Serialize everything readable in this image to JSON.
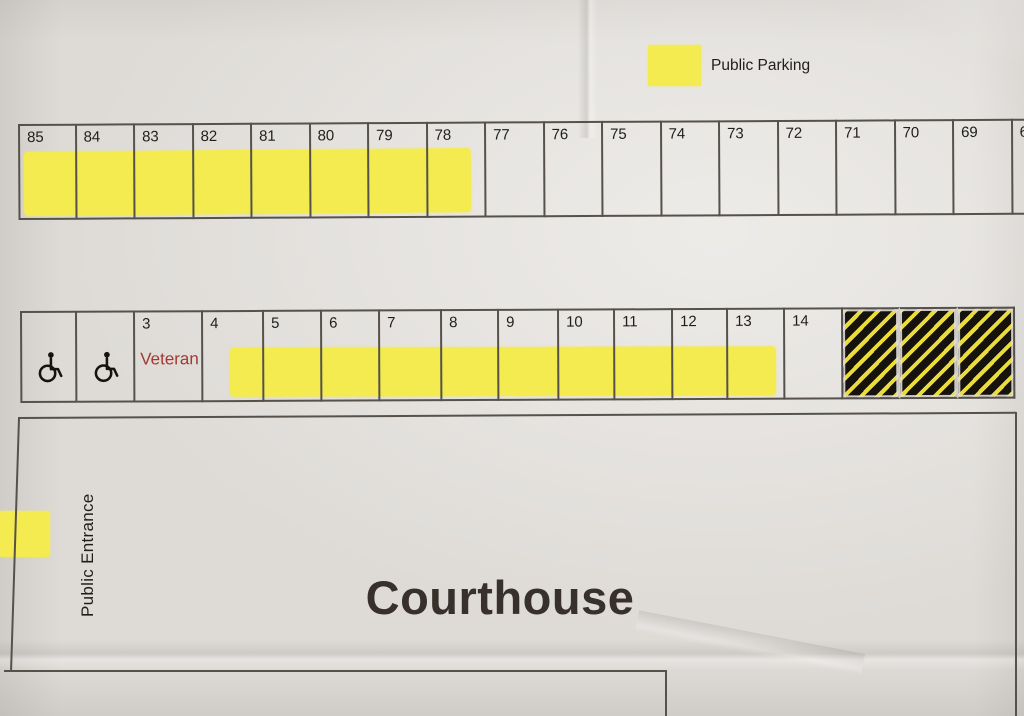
{
  "legend": {
    "label": "Public Parking",
    "swatch": "yellow-highlight-square"
  },
  "top_row": {
    "spaces": [
      "85",
      "84",
      "83",
      "82",
      "81",
      "80",
      "79",
      "78",
      "77",
      "76",
      "75",
      "74",
      "73",
      "72",
      "71",
      "70",
      "69",
      "68"
    ],
    "highlighted_spaces": [
      "85",
      "84",
      "83",
      "82",
      "81",
      "80",
      "79",
      "78"
    ]
  },
  "middle_row": {
    "cells": [
      {
        "type": "handicap",
        "icon": "wheelchair-icon"
      },
      {
        "type": "handicap",
        "icon": "wheelchair-icon"
      },
      {
        "type": "veteran",
        "number": "3",
        "label": "Veteran"
      },
      {
        "type": "space",
        "number": "4"
      },
      {
        "type": "space",
        "number": "5"
      },
      {
        "type": "space",
        "number": "6"
      },
      {
        "type": "space",
        "number": "7"
      },
      {
        "type": "space",
        "number": "8"
      },
      {
        "type": "space",
        "number": "9"
      },
      {
        "type": "space",
        "number": "10"
      },
      {
        "type": "space",
        "number": "11"
      },
      {
        "type": "space",
        "number": "12"
      },
      {
        "type": "space",
        "number": "13"
      },
      {
        "type": "space",
        "number": "14"
      },
      {
        "type": "hatched",
        "pattern": "yellow-black-diagonal-stripes"
      },
      {
        "type": "hatched",
        "pattern": "yellow-black-diagonal-stripes"
      },
      {
        "type": "hatched",
        "pattern": "yellow-black-diagonal-stripes"
      }
    ],
    "highlighted_spaces": [
      "4",
      "5",
      "6",
      "7",
      "8",
      "9",
      "10",
      "11",
      "12",
      "13"
    ]
  },
  "courthouse": {
    "label": "Courthouse",
    "entrance_label": "Public Entrance"
  },
  "colors": {
    "highlight_yellow": "#f3eb4f",
    "hatch_yellow": "#eadc3d",
    "hatch_black": "#16120e",
    "line": "#56514b",
    "ink": "#211e1a",
    "heading_ink": "#38312b",
    "veteran_red": "#a23a31",
    "paper": "#dedbd7"
  }
}
